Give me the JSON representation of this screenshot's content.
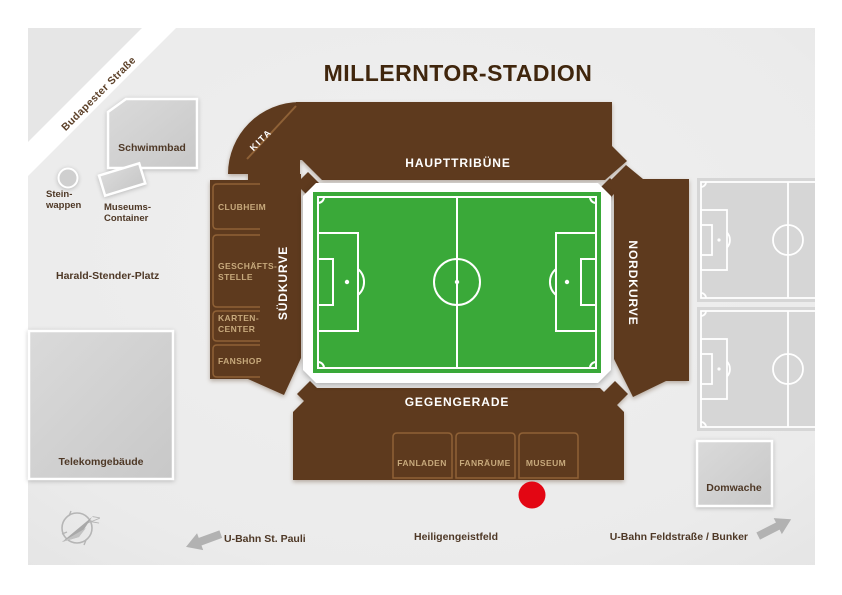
{
  "title": "MILLERNTOR-STADION",
  "stadium": {
    "stands": {
      "north": "HAUPTTRIBÜNE",
      "south": "GEGENGERADE",
      "west": "SÜDKURVE",
      "east": "NORDKURVE"
    },
    "kita": "KITA",
    "west_facilities": [
      {
        "line1": "CLUBHEIM",
        "line2": ""
      },
      {
        "line1": "GESCHÄFTS-",
        "line2": "STELLE"
      },
      {
        "line1": "KARTEN-",
        "line2": "CENTER"
      },
      {
        "line1": "FANSHOP",
        "line2": ""
      }
    ],
    "south_facilities": [
      "FANLADEN",
      "FANRÄUME",
      "MUSEUM"
    ]
  },
  "surroundings": {
    "street": "Budapester Straße",
    "schwimmbad": "Schwimmbad",
    "stein_wappen": {
      "line1": "Stein-",
      "line2": "wappen"
    },
    "museums_container": {
      "line1": "Museums-",
      "line2": "Container"
    },
    "platz": "Harald-Stender-Platz",
    "telekom": "Telekomgebäude",
    "domwache": "Domwache"
  },
  "footer": {
    "ubahn_west": "U-Bahn St. Pauli",
    "field": "Heiligengeistfeld",
    "ubahn_east": "U-Bahn Feldstraße / Bunker",
    "compass_n": "N"
  },
  "colors": {
    "stadium_brown": "#5e3a1e",
    "pitch_green": "#3aa939",
    "marker_red": "#e30613",
    "map_bg": "#ececec",
    "building_gray": "#d2d2d2",
    "division_light_brown": "#8f6136",
    "facility_label_tan": "#c7a97c",
    "title_brown": "#40260d",
    "arrow_gray": "#b2b2b2"
  }
}
